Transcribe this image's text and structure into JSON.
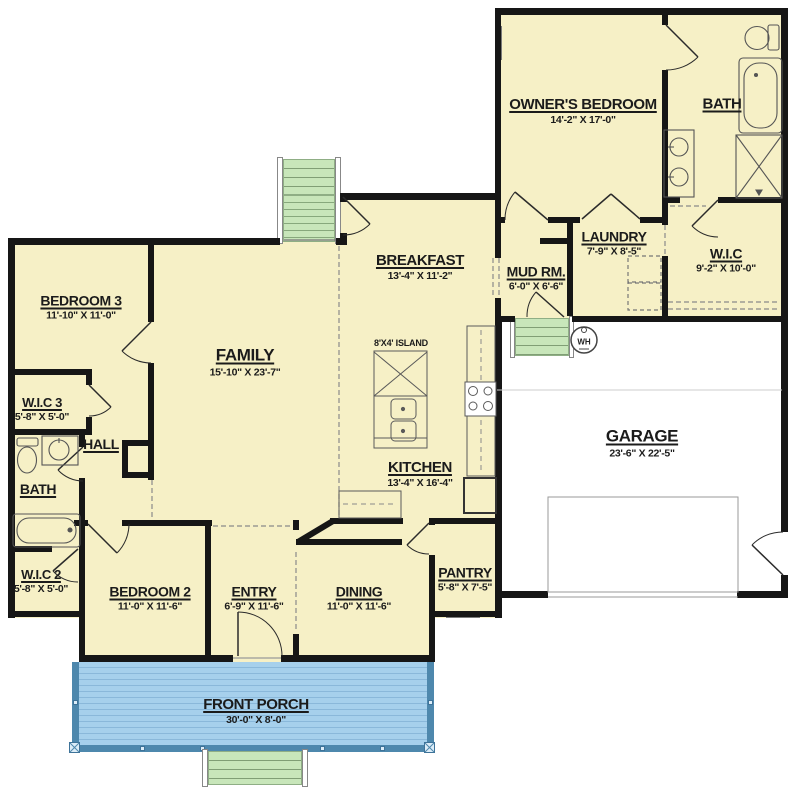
{
  "plan": {
    "title": "House floor plan",
    "rooms": {
      "owners_bedroom": {
        "name": "OWNER'S BEDROOM",
        "dims": "14'-2\" X 17'-0\""
      },
      "bath_owner": {
        "name": "BATH"
      },
      "laundry": {
        "name": "LAUNDRY",
        "dims": "7'-9\" X 8'-5\""
      },
      "wic_owner": {
        "name": "W.I.C",
        "dims": "9'-2\" X 10'-0\""
      },
      "mud_room": {
        "name": "MUD RM.",
        "dims": "6'-0\" X 6'-6\""
      },
      "breakfast": {
        "name": "BREAKFAST",
        "dims": "13'-4\" X 11'-2\""
      },
      "kitchen": {
        "name": "KITCHEN",
        "dims": "13'-4\" X 16'-4\""
      },
      "family": {
        "name": "FAMILY",
        "dims": "15'-10\" X 23'-7\""
      },
      "bedroom3": {
        "name": "BEDROOM 3",
        "dims": "11'-10\" X 11'-0\""
      },
      "wic3": {
        "name": "W.I.C 3",
        "dims": "5'-8\" X 5'-0\""
      },
      "hall": {
        "name": "HALL"
      },
      "bath2": {
        "name": "BATH"
      },
      "wic2": {
        "name": "W.I.C 2",
        "dims": "5'-8\" X 5'-0\""
      },
      "bedroom2": {
        "name": "BEDROOM 2",
        "dims": "11'-0\" X 11'-6\""
      },
      "entry": {
        "name": "ENTRY",
        "dims": "6'-9\" X 11'-6\""
      },
      "dining": {
        "name": "DINING",
        "dims": "11'-0\" X 11'-6\""
      },
      "pantry": {
        "name": "PANTRY",
        "dims": "5'-8\" X 7'-5\""
      },
      "garage": {
        "name": "GARAGE",
        "dims": "23'-6\" X 22'-5\""
      },
      "front_porch": {
        "name": "FRONT PORCH",
        "dims": "30'-0\" X 8'-0\""
      }
    },
    "annotations": {
      "island": "8'X4' ISLAND",
      "water_heater": "WH"
    },
    "colors": {
      "room_fill": "#f6f0c6",
      "wall": "#161616",
      "porch_fill": "#a6d0ec",
      "porch_rail": "#4e88ad",
      "steps_fill": "#c8e6ba"
    }
  }
}
